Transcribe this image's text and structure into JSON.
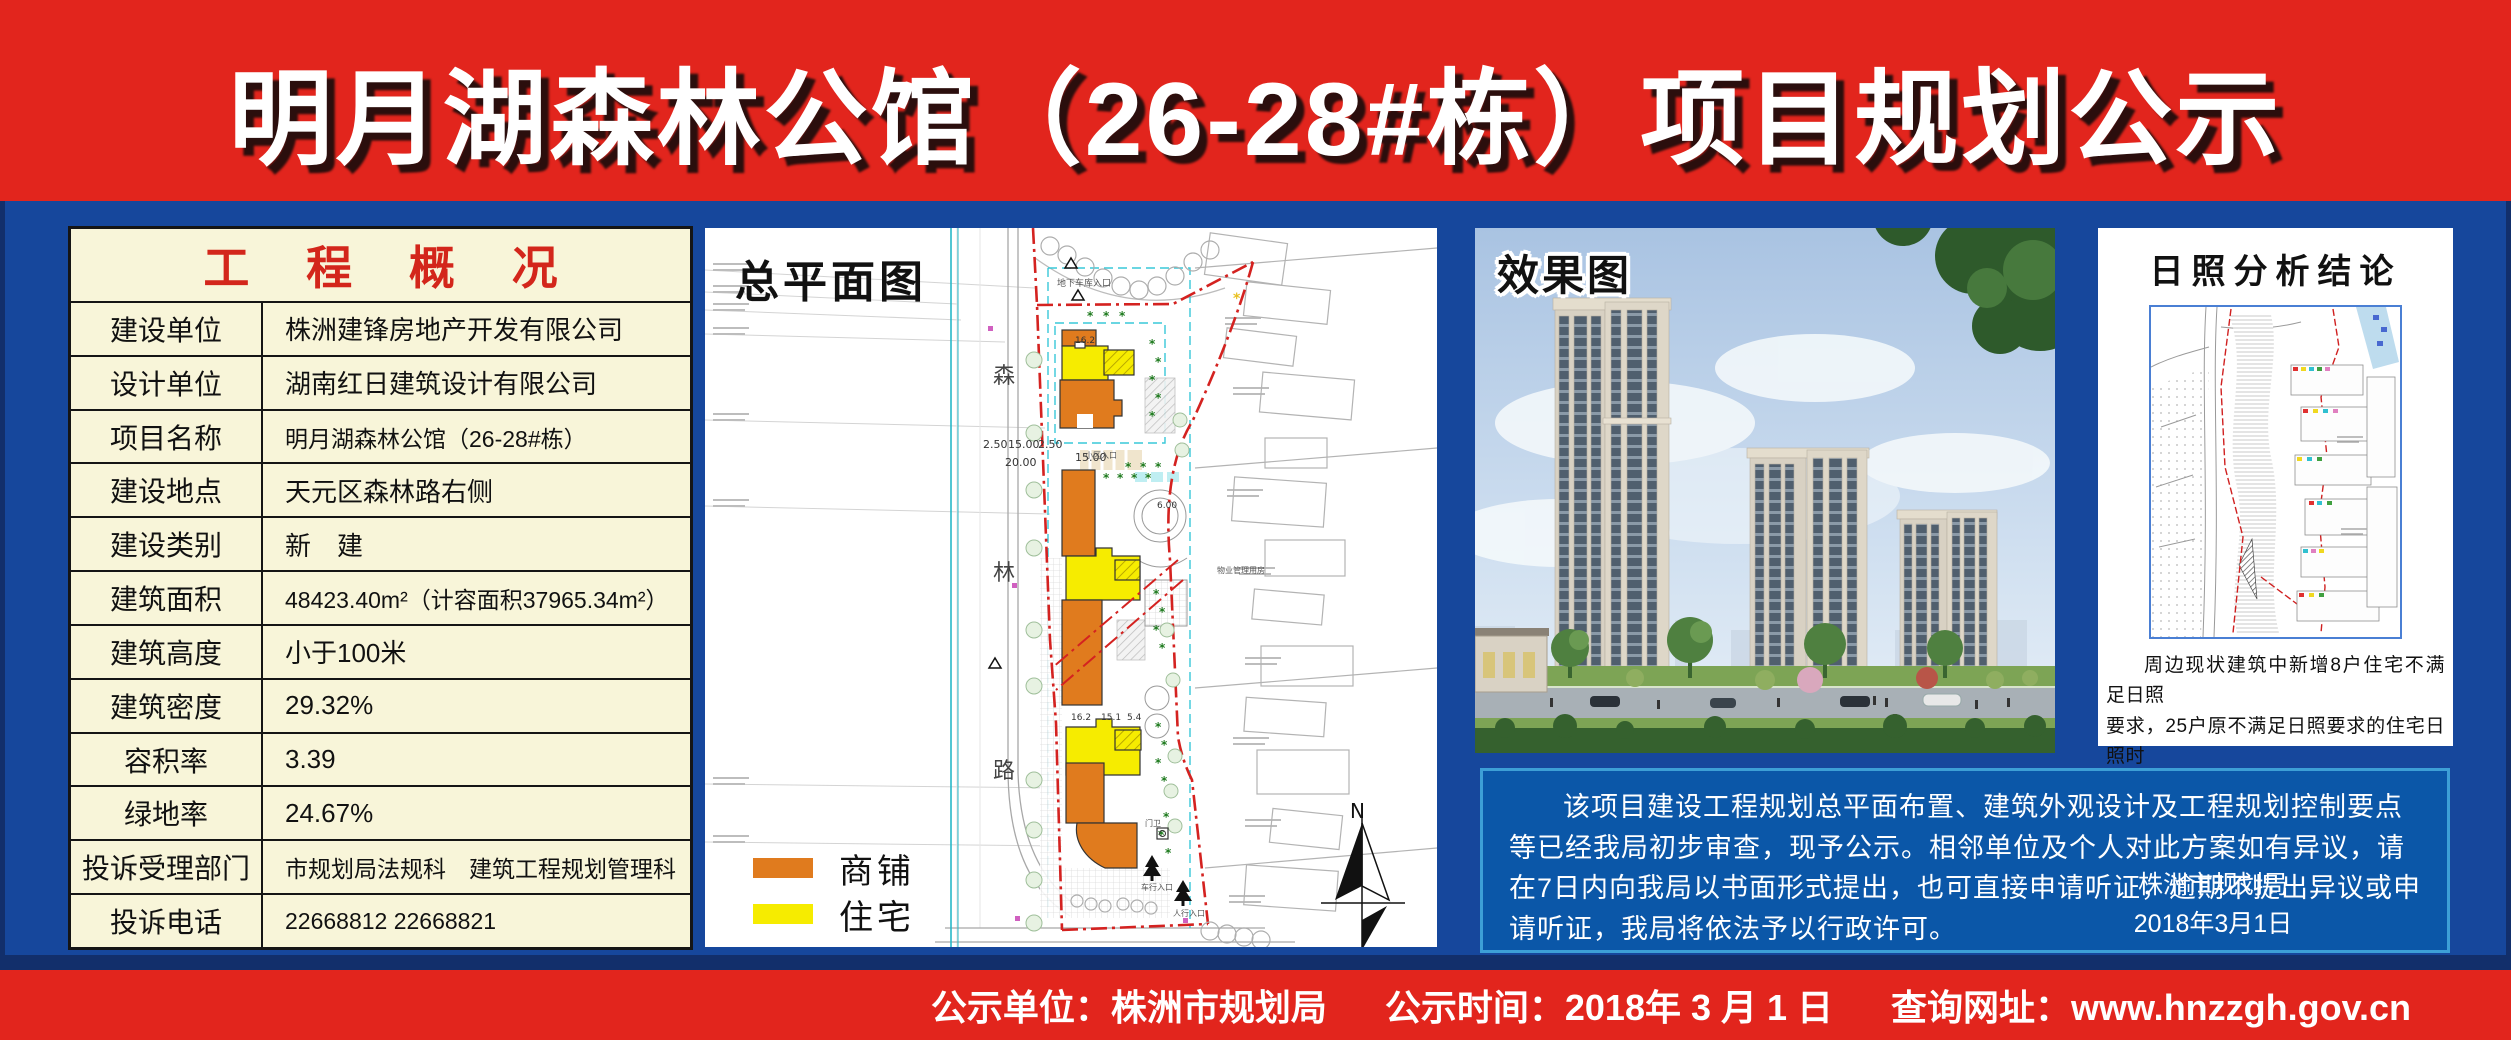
{
  "banner": {
    "title": "明月湖森林公馆（26-28#栋）项目规划公示"
  },
  "overview_table": {
    "header": "工 程 概 况",
    "rows": [
      {
        "label": "建设单位",
        "value": "株洲建锋房地产开发有限公司"
      },
      {
        "label": "设计单位",
        "value": "湖南红日建筑设计有限公司"
      },
      {
        "label": "项目名称",
        "value": "明月湖森林公馆（26-28#栋）"
      },
      {
        "label": "建设地点",
        "value": "天元区森林路右侧"
      },
      {
        "label": "建设类别",
        "value": "新　建"
      },
      {
        "label": "建筑面积",
        "value": "48423.40m²（计容面积37965.34m²）"
      },
      {
        "label": "建筑高度",
        "value": "小于100米"
      },
      {
        "label": "建筑密度",
        "value": "29.32%"
      },
      {
        "label": "容积率",
        "value": "3.39"
      },
      {
        "label": "绿地率",
        "value": "24.67%"
      },
      {
        "label": "投诉受理部门",
        "value": "市规划局法规科　建筑工程规划管理科"
      },
      {
        "label": "投诉电话",
        "value": "22668812  22668821"
      }
    ]
  },
  "site_plan": {
    "title": "总平面图",
    "legend": [
      {
        "label": "商铺",
        "color": "#E07B1E"
      },
      {
        "label": "住宅",
        "color": "#F6EC00"
      }
    ],
    "road_chars": [
      "森",
      "林",
      "路"
    ],
    "north_label": "N",
    "dims": [
      "2.50",
      "15.00",
      "2.50",
      "20.00",
      "15.00",
      "16.2",
      "16.2",
      "15.1",
      "5.4",
      "6.00"
    ],
    "micro_labels": [
      "地下车库入口",
      "小区入口",
      "门卫",
      "车行入口",
      "人行入口",
      "物业管理用房"
    ]
  },
  "rendering": {
    "title": "效果图"
  },
  "sunshine": {
    "title": "日照分析结论",
    "conclusion": "周边现状建筑中新增8户住宅不满足日照\n要求，25户原不满足日照要求的住宅日照时\n间有减少；现状贝尔艺术教育幼儿园日照时\n间有减少。"
  },
  "announcement": {
    "body": "该项目建设工程规划总平面布置、建筑外观设计及工程规划控制要点等已经我局初步审查，现予公示。相邻单位及个人对此方案如有异议，请在7日内向我局以书面形式提出，也可直接申请听证，逾期不提出异议或申请听证，我局将依法予以行政许可。",
    "signer": "株洲市规划局",
    "date": "2018年3月1日"
  },
  "footer": {
    "items": [
      "公示单位：株洲市规划局",
      "公示时间：2018年 3 月 1 日",
      "查询网址：www.hnzzgh.gov.cn"
    ]
  },
  "colors": {
    "banner_red": "#E2251D",
    "background_blue": "#16479C",
    "announce_blue": "#0B57A8",
    "table_cream": "#F8F5D9",
    "shop_orange": "#E07B1E",
    "residence_yellow": "#F6EC00",
    "boundary_red": "#D42220"
  }
}
